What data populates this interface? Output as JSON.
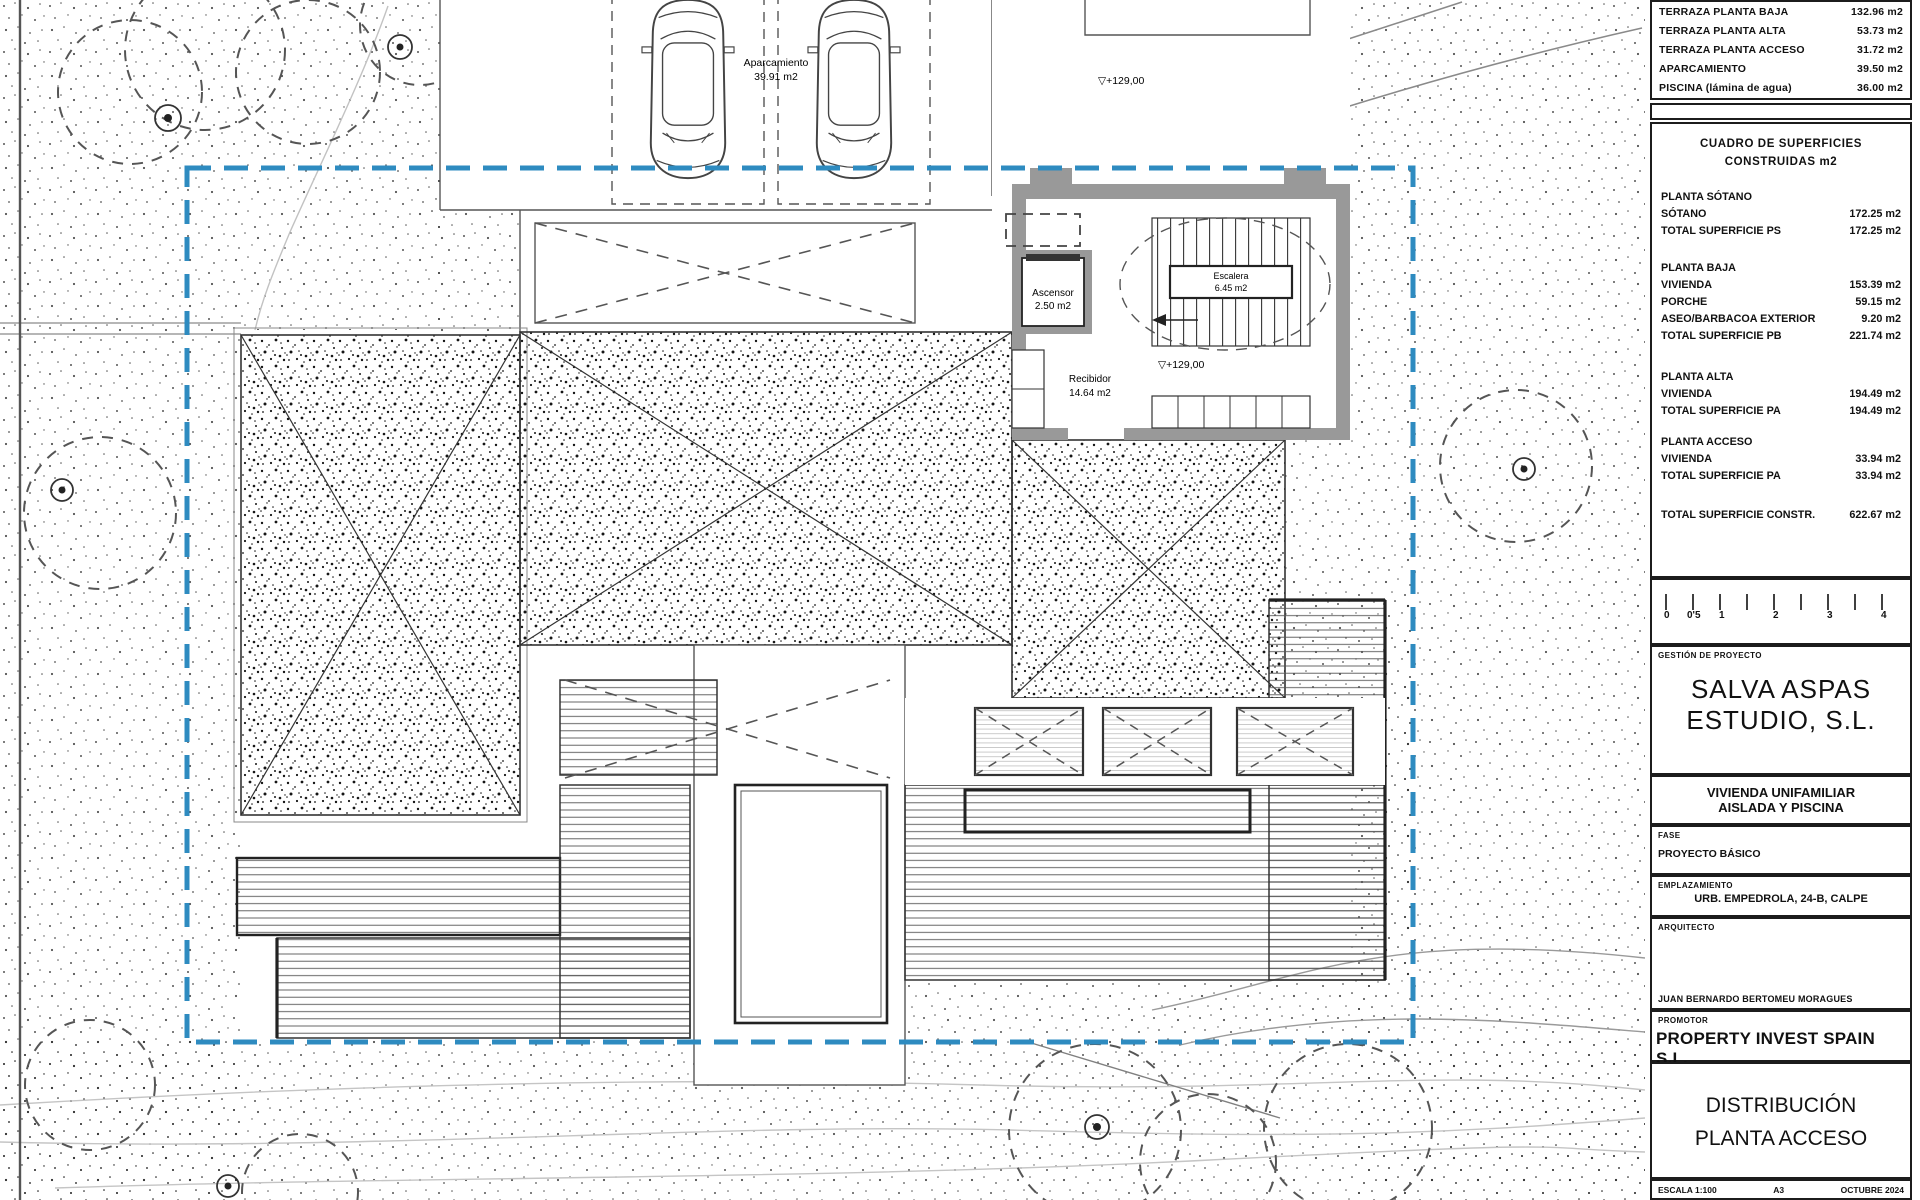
{
  "colors": {
    "boundary": "#2e8bc0",
    "walls": "#999999",
    "header_gray": "#d9d9d9",
    "ink": "#1c1c1c"
  },
  "plan": {
    "aparcamiento_label": "Aparcamiento",
    "aparcamiento_area": "39.91 m2",
    "level_plaza": "▽+129,00",
    "level_hall": "▽+129,00",
    "level_marker": "▽",
    "ascensor_label": "Ascensor",
    "ascensor_area": "2.50 m2",
    "escalera_label": "Escalera",
    "escalera_area": "6.45 m2",
    "recibidor_label": "Recibidor",
    "recibidor_area": "14.64 m2"
  },
  "tb": {
    "surface_table": {
      "rows": [
        {
          "label": "TERRAZA PLANTA BAJA",
          "value": "132.96 m2"
        },
        {
          "label": "TERRAZA PLANTA ALTA",
          "value": "53.73 m2"
        },
        {
          "label": "TERRAZA PLANTA ACCESO",
          "value": "31.72 m2"
        },
        {
          "label": "APARCAMIENTO",
          "value": "39.50 m2"
        },
        {
          "label": "PISCINA (lámina de agua)",
          "value": "36.00 m2"
        }
      ]
    },
    "cuadro": {
      "title1": "CUADRO DE SUPERFICIES",
      "title2": "CONSTRUIDAS m2",
      "sections": [
        {
          "header": "PLANTA SÓTANO",
          "rows": [
            {
              "l": "SÓTANO",
              "v": "172.25 m2"
            },
            {
              "l": "TOTAL SUPERFICIE PS",
              "v": "172.25 m2"
            }
          ]
        },
        {
          "header": "PLANTA BAJA",
          "rows": [
            {
              "l": "VIVIENDA",
              "v": "153.39 m2"
            },
            {
              "l": "PORCHE",
              "v": "59.15 m2"
            },
            {
              "l": "ASEO/BARBACOA EXTERIOR",
              "v": "9.20 m2"
            },
            {
              "l": "TOTAL SUPERFICIE PB",
              "v": "221.74 m2"
            }
          ]
        },
        {
          "header": "PLANTA ALTA",
          "rows": [
            {
              "l": "VIVIENDA",
              "v": "194.49 m2"
            },
            {
              "l": "TOTAL SUPERFICIE PA",
              "v": "194.49 m2"
            }
          ]
        },
        {
          "header": "PLANTA ACCESO",
          "rows": [
            {
              "l": "VIVIENDA",
              "v": "33.94 m2"
            },
            {
              "l": "TOTAL SUPERFICIE PA",
              "v": "33.94 m2"
            }
          ]
        }
      ],
      "total": {
        "l": "TOTAL SUPERFICIE CONSTR.",
        "v": "622.67 m2"
      }
    },
    "scalebar": {
      "labels": [
        "0",
        "0'5",
        "1",
        "2",
        "3",
        "4"
      ]
    },
    "gestion": {
      "label": "GESTIÓN DE PROYECTO",
      "company_line1": "SALVA ASPAS",
      "company_line2": "ESTUDIO, S.L."
    },
    "project": {
      "line1": "VIVIENDA UNIFAMILIAR",
      "line2": "AISLADA Y PISCINA"
    },
    "fase": {
      "label": "FASE",
      "value": "PROYECTO BÁSICO"
    },
    "emplazamiento": {
      "label": "EMPLAZAMIENTO",
      "value": "URB. EMPEDROLA, 24-B, CALPE"
    },
    "arquitecto": {
      "label": "ARQUITECTO",
      "value": "JUAN BERNARDO BERTOMEU MORAGUES"
    },
    "promotor": {
      "label": "PROMOTOR",
      "value": "PROPERTY INVEST SPAIN S.L."
    },
    "sheet": {
      "line1": "DISTRIBUCIÓN",
      "line2": "PLANTA ACCESO"
    },
    "footer": {
      "escala": "ESCALA 1:100",
      "format": "A3",
      "date": "OCTUBRE 2024"
    }
  }
}
